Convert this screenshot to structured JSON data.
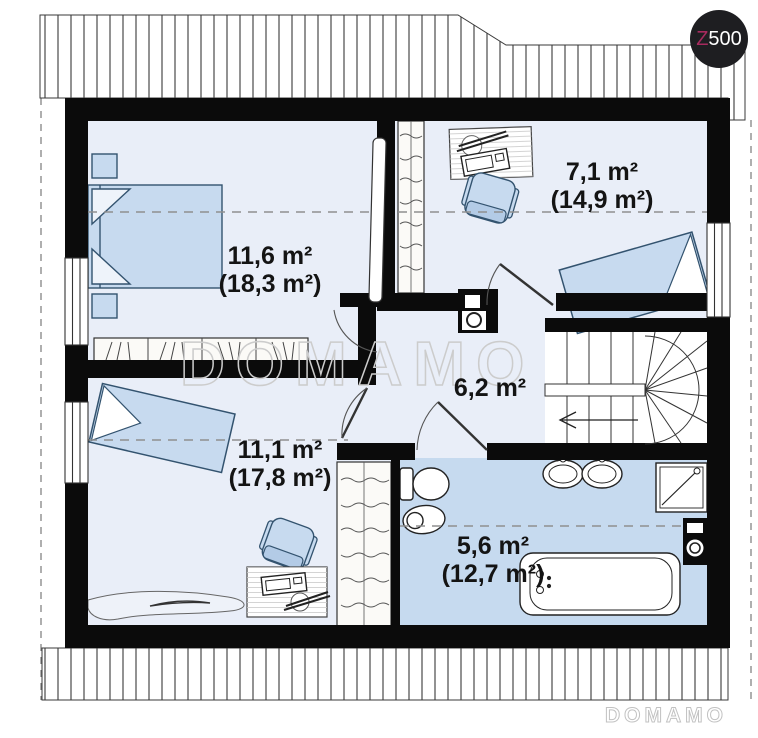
{
  "branding": {
    "logo_text_primary": "Z",
    "logo_text_secondary": "500",
    "watermark": "DOMAMO",
    "footer_watermark": "DOMAMO"
  },
  "rooms": [
    {
      "name": "bedroom-top-left",
      "area": "11,6 m²",
      "total_area": "(18,3 m²)"
    },
    {
      "name": "room-top-right",
      "area": "7,1 m²",
      "total_area": "(14,9 m²)"
    },
    {
      "name": "hall",
      "area": "6,2 m²",
      "total_area": ""
    },
    {
      "name": "bedroom-bottom-left",
      "area": "11,1 m²",
      "total_area": "(17,8 m²)"
    },
    {
      "name": "bathroom",
      "area": "5,6 m²",
      "total_area": "(12,7 m²)"
    }
  ],
  "colors": {
    "wall": "#0b0b0b",
    "room_floor": "#e9eef8",
    "bathroom_floor": "#c6daef",
    "furniture_fill": "#c7daef",
    "furniture_stroke": "#33536f",
    "watermark": "#cccccc",
    "logo_background": "#1e1e21",
    "logo_accent": "#a72a5e"
  }
}
